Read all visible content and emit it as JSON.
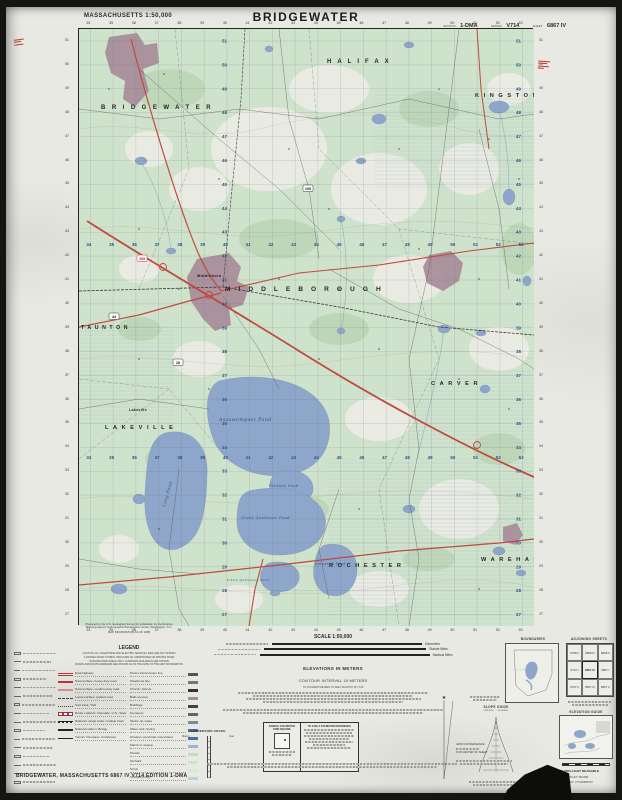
{
  "header": {
    "state_scale": "MASSACHUSETTS 1:50,000",
    "title": "BRIDGEWATER",
    "edition_label": "EDITION",
    "edition": "1-DMA",
    "series_label": "SERIES",
    "series": "V714",
    "sheet_label": "SHEET",
    "sheet": "6867 IV"
  },
  "credits": {
    "prepared_1": "Prepared by the U.S. Geological Survey for publication by the Defense",
    "prepared_2": "Mapping Agency Hydrographic/Topographic Center, Washington, D.C.",
    "info": "MAP INFORMATION AS OF 1985"
  },
  "legend": {
    "title": "LEGEND",
    "notes": [
      "CAUTION: ALL TELEPHONE AND ELECTRIC SERVICE LINES ARE NOT SHOWN",
      "A DASHED ROAD SYMBOL INDICATES AN UNIMPROVED OR PRIVATE ROAD",
      "IN DEVELOPED AREAS ONLY LANDMARK BUILDINGS ARE SHOWN",
      "ROADS AND ROUTE MARKERS ARE SHOWN AS OF THE DATE OF THE MAP INFORMATION"
    ],
    "left_items": [
      "Dual highway",
      "Hard surface, heavy duty road",
      "Hard surface, medium duty road",
      "Loose surface, graded road",
      "Cart track; Trail",
      "Route markers: Interstate; U.S.; State",
      "Railroad: single track; multiple track",
      "Railroad station; Bridge",
      "Tunnel; Overpass; Underpass"
    ],
    "right_items": [
      "Power transmission line",
      "Telephone line",
      "Church; School",
      "Built-up area",
      "Buildings",
      "Cemetery",
      "Tanks: oil, water",
      "Water well; Spring",
      "Streams: perennial; intermittent",
      "Marsh or swamp",
      "Woods",
      "Orchard",
      "Scrub",
      "Cranberry bog"
    ]
  },
  "scale": {
    "title": "SCALE 1:50,000",
    "units": [
      "Kilometers",
      "Statute Miles",
      "Nautical Miles"
    ],
    "elevations": "ELEVATIONS IN METERS",
    "contour": "CONTOUR INTERVAL 10 METERS",
    "conversion_note": "TO CONVERT METERS TO FEET MULTIPLY BY 3.28"
  },
  "grid_box": {
    "left_title": "SAMPLE 1000 METER GRID SQUARE",
    "right_title": "TO GIVE A STANDARD REFERENCE"
  },
  "conversion_graph": {
    "title": "CONVERSION GRAPH",
    "left_unit": "Meters",
    "right_unit": "Feet"
  },
  "panels": {
    "boundaries_title": "BOUNDARIES",
    "adjoining_title": "ADJOINING SHEETS",
    "adjoining_cells": [
      "6768 II",
      "6868 III",
      "6868 II",
      "6767 I",
      "6867 IV",
      "6867 I",
      "6767 II",
      "6867 III",
      "6867 II"
    ],
    "elevation_guide_title": "ELEVATION GUIDE",
    "slope_guide_title": "SLOPE GUIDE",
    "slope_cols": "PERCENT      DEGREES",
    "convergence_1": "GRID CONVERGENCE",
    "convergence_2": "FOR CENTER OF SHEET",
    "red_light": "THIS MAP IS RED-LIGHT READABLE",
    "usgs_no": "USGS 41070-E7-TM-050",
    "stock_no": "DMA STOCK NO. V714X6867IV"
  },
  "footer": {
    "line": "BRIDGEWATER, MASSACHUSETTS    6867 IV    V714    EDITION 1-DMA"
  },
  "map": {
    "towns": [
      {
        "name": "BRIDGEWATER",
        "x": 22,
        "y": 80,
        "s": 6,
        "ls": 6.5
      },
      {
        "name": "HALIFAX",
        "x": 248,
        "y": 34,
        "s": 6,
        "ls": 6
      },
      {
        "name": "KINGSTON",
        "x": 396,
        "y": 68,
        "s": 5.6,
        "ls": 4.6
      },
      {
        "name": "MIDDLEBOROUGH",
        "x": 146,
        "y": 262,
        "s": 6.6,
        "ls": 8
      },
      {
        "name": "LAKEVILLE",
        "x": 26,
        "y": 400,
        "s": 5.6,
        "ls": 4.6
      },
      {
        "name": "TAUNTON",
        "x": 2,
        "y": 300,
        "s": 5.2,
        "ls": 3.6
      },
      {
        "name": "CARVER",
        "x": 352,
        "y": 356,
        "s": 5.6,
        "ls": 4.6
      },
      {
        "name": "ROCHESTER",
        "x": 250,
        "y": 538,
        "s": 5.6,
        "ls": 4.6
      },
      {
        "name": "WAREHAM",
        "x": 402,
        "y": 532,
        "s": 5.6,
        "ls": 4.6
      }
    ],
    "villages": [
      {
        "name": "Middleboro",
        "x": 118,
        "y": 248,
        "s": 4
      },
      {
        "name": "Lakeville",
        "x": 50,
        "y": 382,
        "s": 3.6
      }
    ],
    "waters": [
      {
        "name": "Assawompset  Pond",
        "x": 140,
        "y": 392,
        "s": 4.6,
        "rot": 0
      },
      {
        "name": "Long Pond",
        "x": 86,
        "y": 478,
        "s": 4,
        "rot": -74
      },
      {
        "name": "Pocksha Pond",
        "x": 190,
        "y": 458,
        "s": 3.4,
        "rot": 0
      },
      {
        "name": "Great Quittacas Pond",
        "x": 162,
        "y": 490,
        "s": 3.6,
        "rot": 0
      },
      {
        "name": "Little Quittacas Pond",
        "x": 148,
        "y": 552,
        "s": 3,
        "rot": 0
      },
      {
        "name": "Snipatuit Pond",
        "x": 236,
        "y": 536,
        "s": 3.2,
        "rot": 0
      }
    ],
    "shields": [
      {
        "num": "495",
        "x": 58,
        "y": 226,
        "kind": "interstate"
      },
      {
        "num": "44",
        "x": 30,
        "y": 284,
        "kind": "us"
      },
      {
        "num": "105",
        "x": 224,
        "y": 156,
        "kind": "state"
      },
      {
        "num": "28",
        "x": 94,
        "y": 330,
        "kind": "state"
      }
    ],
    "grid": {
      "easting_start": 34,
      "northing_start": 51,
      "cols": 20,
      "rows": 25,
      "x0": 11.4,
      "y0": 12,
      "dx": 22.75,
      "dy": 23.9
    },
    "colors": {
      "water": "#8ea6c9",
      "woods": "#cfe2cb",
      "builtup": "#a78c99",
      "road_primary": "#bf4a40",
      "grid_blue": "#2e4d8c"
    }
  }
}
